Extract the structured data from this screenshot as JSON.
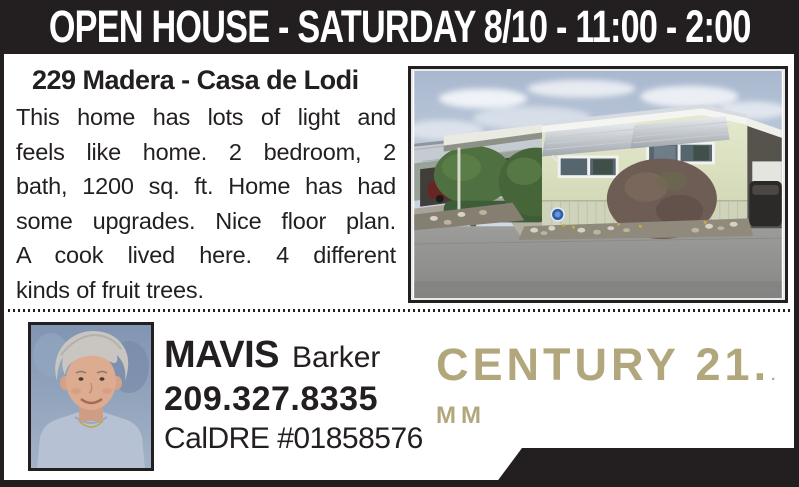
{
  "header": {
    "title": "OPEN HOUSE - SATURDAY 8/10 - 11:00 - 2:00"
  },
  "listing": {
    "title": "229 Madera - Casa de Lodi",
    "description_lines": [
      "This home has lots of light and",
      "feels like home. 2 bedroom, 2",
      "bath, 1200 sq. ft. Home has had",
      "some upgrades. Nice floor plan.",
      "A cook lived here. 4 different",
      "kinds of fruit trees."
    ],
    "photo": {
      "house_number": "229"
    }
  },
  "agent": {
    "first_name": "MAVIS",
    "last_name": "Barker",
    "phone": "209.327.8335",
    "license": "CalDRE #01858576"
  },
  "brand": {
    "name": "CENTURY 21.",
    "reg_dot": ".",
    "office": "MM"
  },
  "colors": {
    "ink": "#231f20",
    "brand_gold": "#b2a77c",
    "paper": "#ffffff"
  }
}
